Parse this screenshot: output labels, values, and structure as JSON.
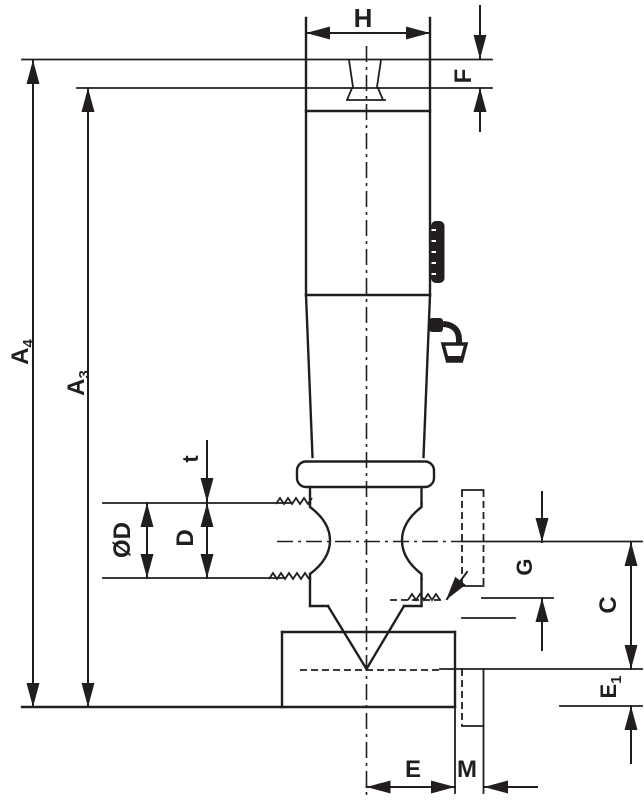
{
  "drawing": {
    "type": "technical-dimension-drawing",
    "ink_color": "#221e1f",
    "background_color": "#ffffff"
  },
  "labels": {
    "H": "H",
    "F": "F",
    "A4": {
      "base": "A",
      "sub": "4"
    },
    "A3": {
      "base": "A",
      "sub": "3"
    },
    "t": "t",
    "OD": "ØD",
    "D": "D",
    "G": "G",
    "C": "C",
    "E1": {
      "base": "E",
      "sub": "1"
    },
    "E": "E",
    "M": "M"
  },
  "symbols": {
    "knurl_band": "black knurl/marking band on shank right edge",
    "finish_mark": "surface finish symbol pointing at shank surface",
    "thread_marks": "zigzag thread-run marks",
    "center_line": "vertical axis center line",
    "groove_center_line": "horizontal groove center line",
    "hidden_feature": "dashed hidden key/tang feature lower right",
    "drill_cone": "60-degree drill point cone inside bottom block"
  }
}
